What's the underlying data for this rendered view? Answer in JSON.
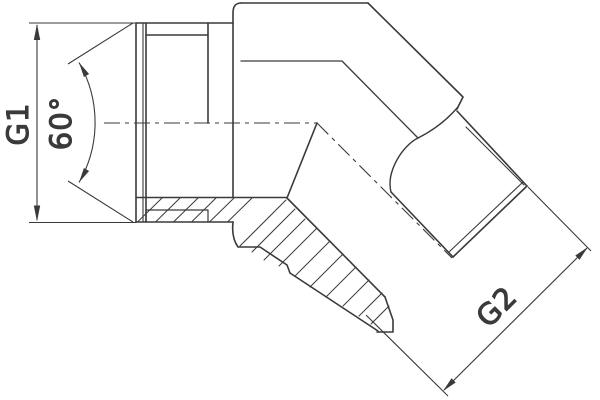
{
  "drawing": {
    "labels": {
      "g1": "G1",
      "angle": "60°",
      "g2": "G2"
    },
    "colors": {
      "line": "#3a3a3a",
      "background": "#ffffff"
    }
  }
}
